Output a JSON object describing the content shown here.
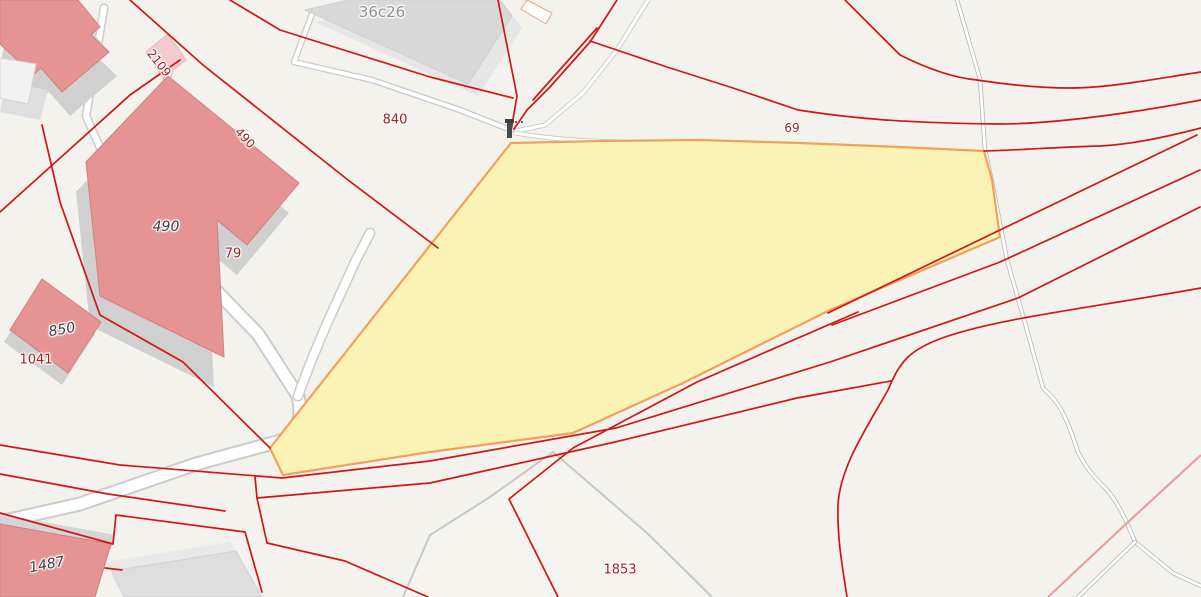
{
  "map": {
    "type": "cadastral-web-map",
    "labels": {
      "building_36c26": "36c26",
      "parcel_2109": "2109",
      "parcel_490_rot": "490",
      "parcel_840": "840",
      "building_490": "490",
      "parcel_79": "79",
      "building_850": "850",
      "parcel_1041": "1041",
      "building_1487": "1487",
      "parcel_69": "69",
      "parcel_1853": "1853"
    },
    "selected_parcel": {
      "fill": "#fbf3b5",
      "border": "#efa258"
    },
    "colors": {
      "background": "#f3f2ec",
      "cadastral_line": "#d21616",
      "cadastral_line_light": "#e89f9f",
      "building_red_fill": "#e59493",
      "building_red_outline": "#d07f7f",
      "building_pink_fill": "#f1cbce",
      "building_gray_fill": "#d8d8d8",
      "building_wall_gray": "#d0d0d0",
      "road_fill": "#ffffff",
      "road_casing": "#cccccc",
      "track_gray": "#b8b8b8",
      "landuse_outline_gray": "#c8c8c8",
      "parcel_label_color": "#9e2323",
      "building_label_color": "#3f3f3f",
      "building_label_gray": "#8f8f8f"
    },
    "icons": {
      "chimney": "chimney-icon"
    }
  }
}
